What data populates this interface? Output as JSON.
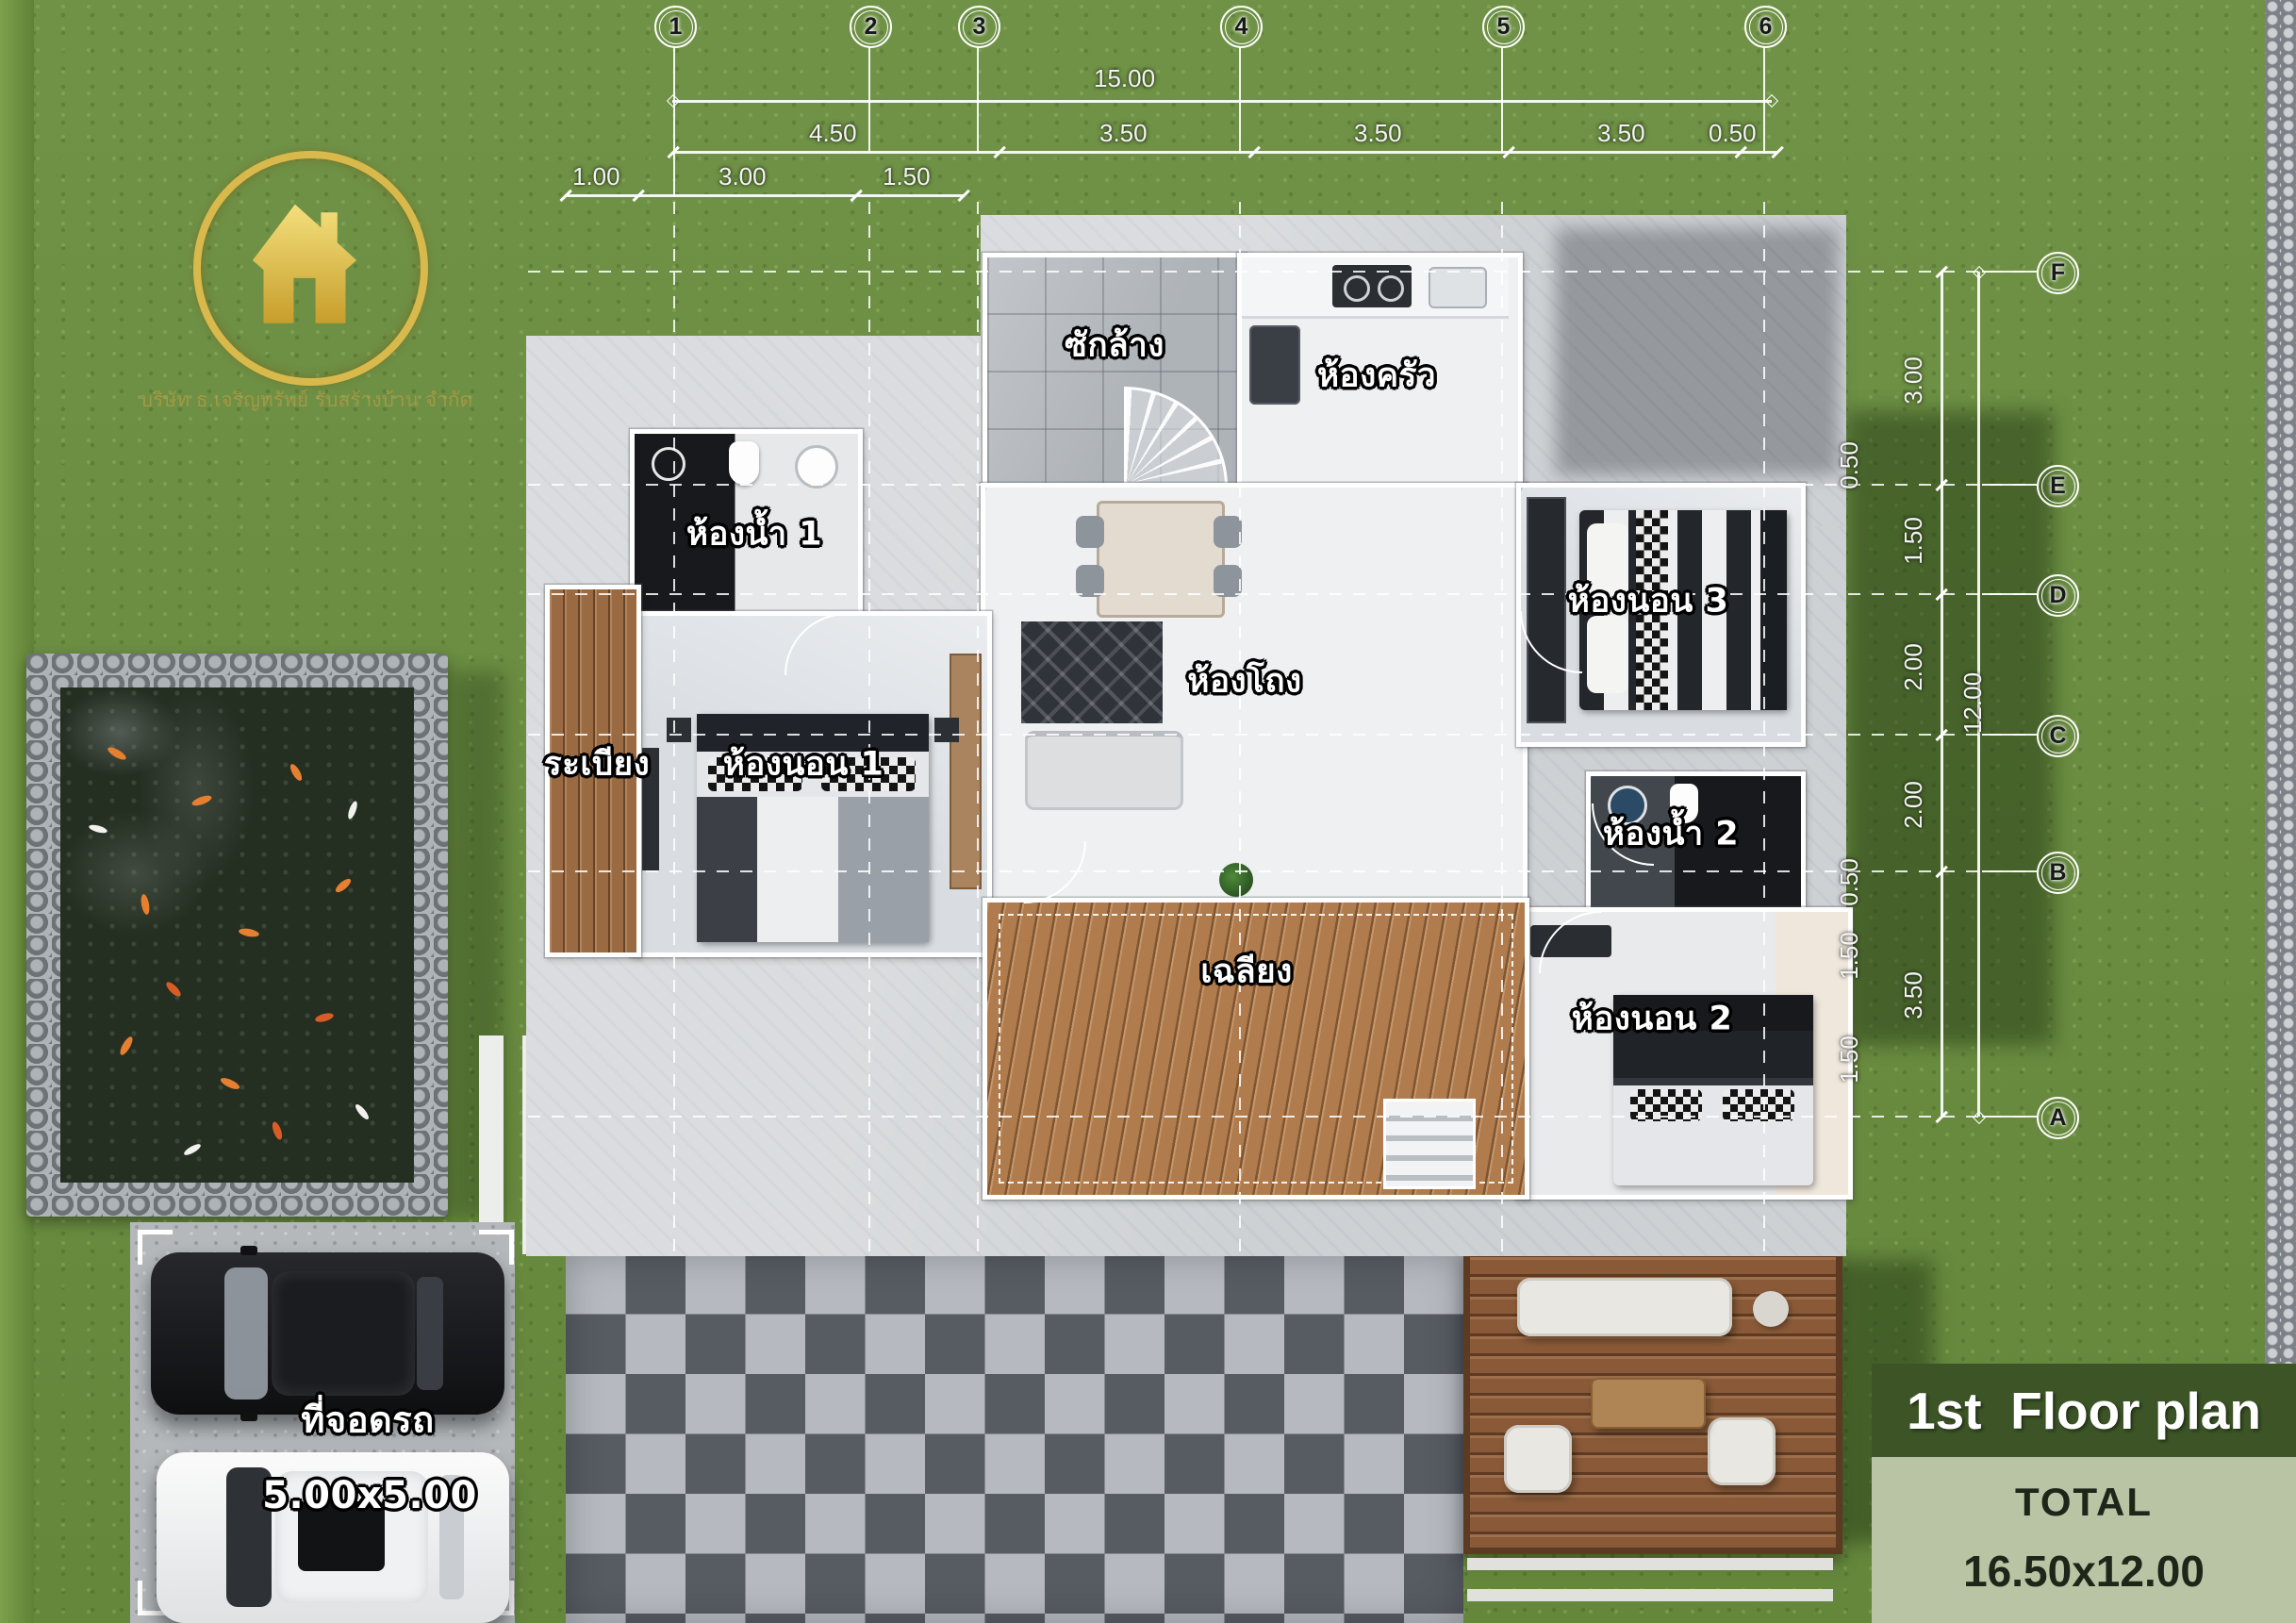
{
  "branding": {
    "tagline": "บริษัท ธ.เจริญทรัพย์ รับสร้างบ้าน จำกัด"
  },
  "grid": {
    "columns": [
      "1",
      "2",
      "3",
      "4",
      "5",
      "6"
    ],
    "rows": [
      "F",
      "E",
      "D",
      "C",
      "B",
      "A"
    ]
  },
  "dims": {
    "top": {
      "overall": "15.00",
      "chain": [
        "4.50",
        "3.50",
        "3.50",
        "3.50",
        "0.50"
      ],
      "sub": [
        "1.00",
        "3.00",
        "1.50"
      ]
    },
    "right": {
      "overall": "12.00",
      "chain": [
        "3.00",
        "1.50",
        "2.00",
        "2.00",
        "3.50"
      ],
      "offsets": [
        "0.50",
        "0.50",
        "1.50",
        "1.50"
      ]
    }
  },
  "rooms": {
    "laundry": "ซักล้าง",
    "kitchen": "ห้องครัว",
    "bath1": "ห้องน้ำ 1",
    "hall": "ห้องโถง",
    "bed3": "ห้องนอน 3",
    "balcony": "ระเบียง",
    "bed1": "ห้องนอน 1",
    "bath2": "ห้องน้ำ 2",
    "porch": "เฉลียง",
    "bed2": "ห้องนอน 2"
  },
  "parking": {
    "label": "ที่จอดรถ",
    "size": "5.00x5.00"
  },
  "badge": {
    "title": "1st  Floor plan",
    "total_label": "TOTAL",
    "total_value": "16.50x12.00"
  },
  "colors": {
    "grass": "#6a8e3f",
    "band_green": "#3c5426",
    "panel_sage": "#b9c4a4",
    "accent_gold": "#d9b94b"
  }
}
